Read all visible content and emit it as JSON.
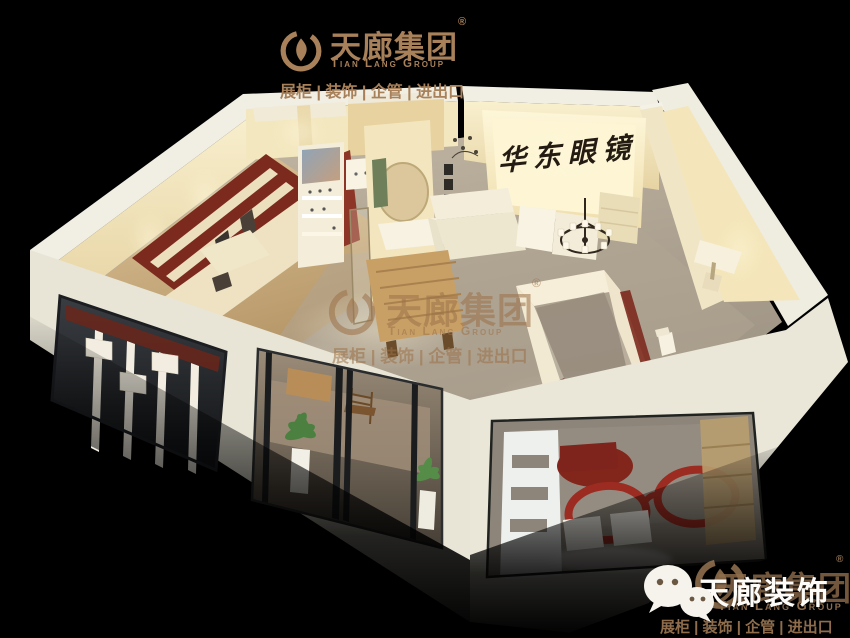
{
  "colors": {
    "background": "#000000",
    "brand_bronze": "#a8815a",
    "wall_cream": "#f2e7c2",
    "wall_top_white": "#f1eee3",
    "accent_maroon": "#7c2a1e",
    "glasses_red": "#9c2b21",
    "floor_gray": "#aca290",
    "floor_wood": "#c9a26a",
    "sign_text_black": "#241c12",
    "plant_green": "#4c8040",
    "overlay_white": "#fdfcf8"
  },
  "icons": {
    "brand_mark": "flame-drop-ring-icon",
    "wechat": "wechat-icon"
  },
  "header_logo": {
    "brand": "天廊集团",
    "registered_mark": "®",
    "english": "Tian Lang Group",
    "tagline": "展柜 | 装饰 | 企管 | 进出口"
  },
  "store_sign": {
    "text": "华东眼镜"
  },
  "center_watermark": {
    "brand": "天廊集团",
    "registered_mark": "®",
    "english": "Tian Lang Group",
    "tagline": "展柜 | 装饰 | 企管 | 进出口"
  },
  "footer_logo": {
    "overlay_brand": "天廊装饰",
    "brand": "天廊集团",
    "registered_mark": "®",
    "english": "Tian Lang Group",
    "tagline": "展柜 | 装饰 | 企管 | 进出口"
  }
}
